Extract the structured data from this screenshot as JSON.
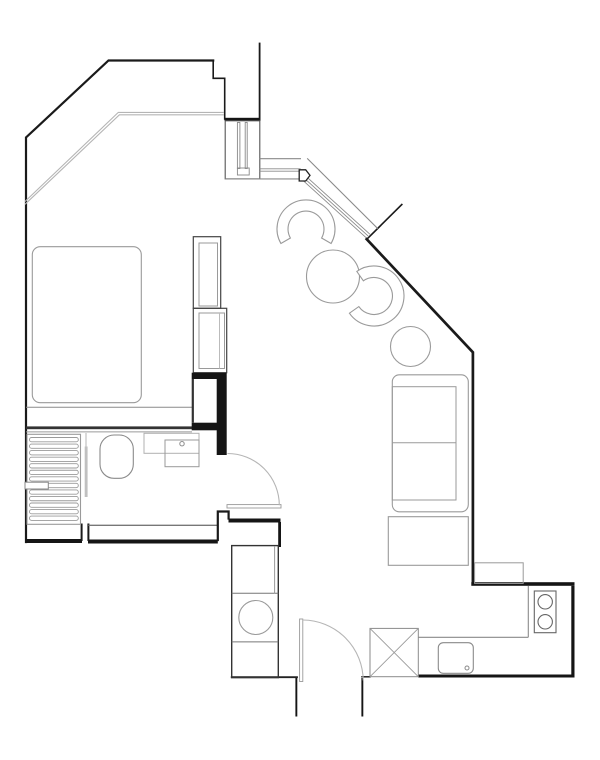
{
  "title": "apartment-floor-plan",
  "colors": {
    "background": "#ffffff",
    "wall": "#1a1a1a",
    "wall_medium": "#444444",
    "partition_gray": "#777777",
    "furniture_line": "#9a9a9a",
    "fixture_line": "#8a8a8a",
    "glazing_line": "#b5b5b5"
  },
  "rooms": {
    "bedroom": [
      "bed",
      "shelving-unit-upper",
      "shelving-unit-lower",
      "wardrobe-closet"
    ],
    "bathroom": [
      "shower-tray",
      "shower-glass",
      "toilet",
      "vanity-counter",
      "washbasin",
      "bathroom-door"
    ],
    "living": [
      "round-table",
      "side-table-round",
      "tub-chair-left",
      "tub-chair-right",
      "sofa",
      "coffee-table",
      "balcony-ledge"
    ],
    "kitchen": [
      "kitchen-counter",
      "washing-machine",
      "stove-two-burners",
      "kitchen-sink",
      "shaft-x-box"
    ],
    "entry": [
      "entry-door"
    ]
  },
  "shower": {
    "slat_count": 13,
    "x": 29.5,
    "y": 437.5,
    "width": 48.8,
    "slat_height": 4.3,
    "pitch": 6.55
  },
  "chairs": [
    {
      "name": "tub-chair-left",
      "cx": 306,
      "cy": 229,
      "r_outer": 29,
      "r_inner": 18,
      "a_start": 150,
      "a_end": 390
    },
    {
      "name": "tub-chair-right",
      "cx": 374,
      "cy": 296,
      "r_outer": 30,
      "r_inner": 18.5,
      "a_start": 235,
      "a_end": 505
    }
  ],
  "tables": [
    {
      "name": "round-table",
      "cx": 333,
      "cy": 276.5,
      "r": 26.5
    },
    {
      "name": "side-table-round",
      "cx": 410.5,
      "cy": 346.5,
      "r": 20
    }
  ],
  "doors": [
    {
      "name": "bathroom-door",
      "hinge_x": 227.5,
      "hinge_y": 505.3,
      "radius": 51.8
    },
    {
      "name": "entry-door",
      "hinge_x": 302.8,
      "hinge_y": 680.8,
      "radius": 60.8
    }
  ]
}
